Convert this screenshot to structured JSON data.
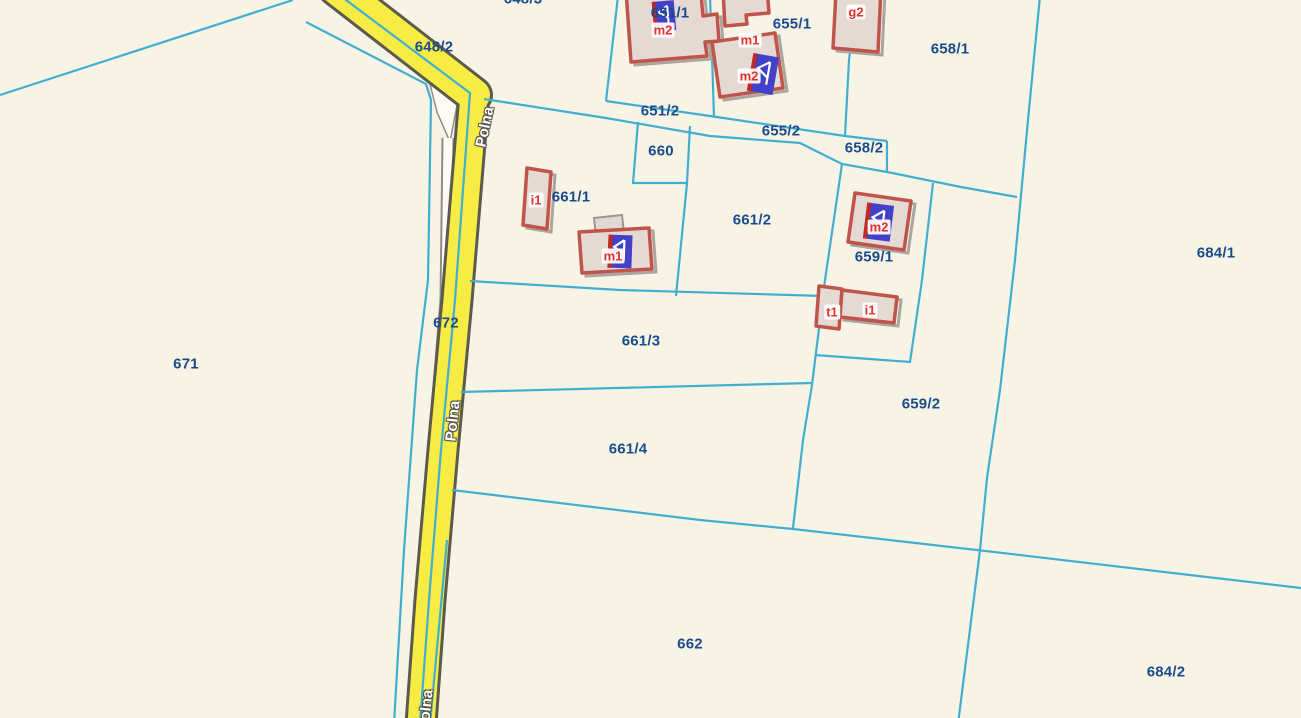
{
  "map": {
    "type": "cadastral-parcel-map",
    "street": {
      "name": "Polna"
    },
    "colors": {
      "background": "#f8f4e5",
      "parcel_boundary": "#41aed1",
      "parcel_label": "#1a4c8c",
      "road_fill": "#f6ec44",
      "road_casing": "#5b5a4e",
      "sidewalk_fill": "#fcfbf4",
      "sidewalk_casing": "#8d8d85",
      "building_outline": "#c0544b",
      "building_fill": "#e4dad3",
      "building_label": "#e23228",
      "address_flag": "#4341c9",
      "address_flag_stripe": "#c4281f",
      "street_label": "#ffffff"
    }
  },
  "street_labels": [
    {
      "text": "Polna",
      "x": 485,
      "y": 127,
      "rot": -78
    },
    {
      "text": "Polna",
      "x": 453,
      "y": 421,
      "rot": -84
    },
    {
      "text": "Polna",
      "x": 426,
      "y": 710,
      "rot": -84
    }
  ],
  "parcel_labels": [
    {
      "id": "648/3",
      "x": 523,
      "y": -1
    },
    {
      "id": "648/2",
      "x": 434,
      "y": 47
    },
    {
      "id": "651/1",
      "x": 670,
      "y": 13
    },
    {
      "id": "655/1",
      "x": 792,
      "y": 24
    },
    {
      "id": "658/1",
      "x": 950,
      "y": 49
    },
    {
      "id": "651/2",
      "x": 660,
      "y": 111
    },
    {
      "id": "655/2",
      "x": 781,
      "y": 131
    },
    {
      "id": "658/2",
      "x": 864,
      "y": 148
    },
    {
      "id": "660",
      "x": 661,
      "y": 151
    },
    {
      "id": "661/1",
      "x": 571,
      "y": 197
    },
    {
      "id": "661/2",
      "x": 752,
      "y": 220
    },
    {
      "id": "684/1",
      "x": 1216,
      "y": 253
    },
    {
      "id": "659/1",
      "x": 874,
      "y": 257
    },
    {
      "id": "672",
      "x": 446,
      "y": 323
    },
    {
      "id": "671",
      "x": 186,
      "y": 364
    },
    {
      "id": "661/3",
      "x": 641,
      "y": 341
    },
    {
      "id": "659/2",
      "x": 921,
      "y": 404
    },
    {
      "id": "661/4",
      "x": 628,
      "y": 449
    },
    {
      "id": "662",
      "x": 690,
      "y": 644
    },
    {
      "id": "684/2",
      "x": 1166,
      "y": 672
    }
  ],
  "building_labels": [
    {
      "code": "m2",
      "x": 663,
      "y": 30
    },
    {
      "code": "m1",
      "x": 750,
      "y": 40
    },
    {
      "code": "m2",
      "x": 749,
      "y": 76
    },
    {
      "code": "g2",
      "x": 856,
      "y": 12
    },
    {
      "code": "i1",
      "x": 536,
      "y": 200
    },
    {
      "code": "m1",
      "x": 613,
      "y": 256
    },
    {
      "code": "m2",
      "x": 879,
      "y": 227
    },
    {
      "code": "t1",
      "x": 832,
      "y": 312
    },
    {
      "code": "i1",
      "x": 870,
      "y": 310
    }
  ]
}
